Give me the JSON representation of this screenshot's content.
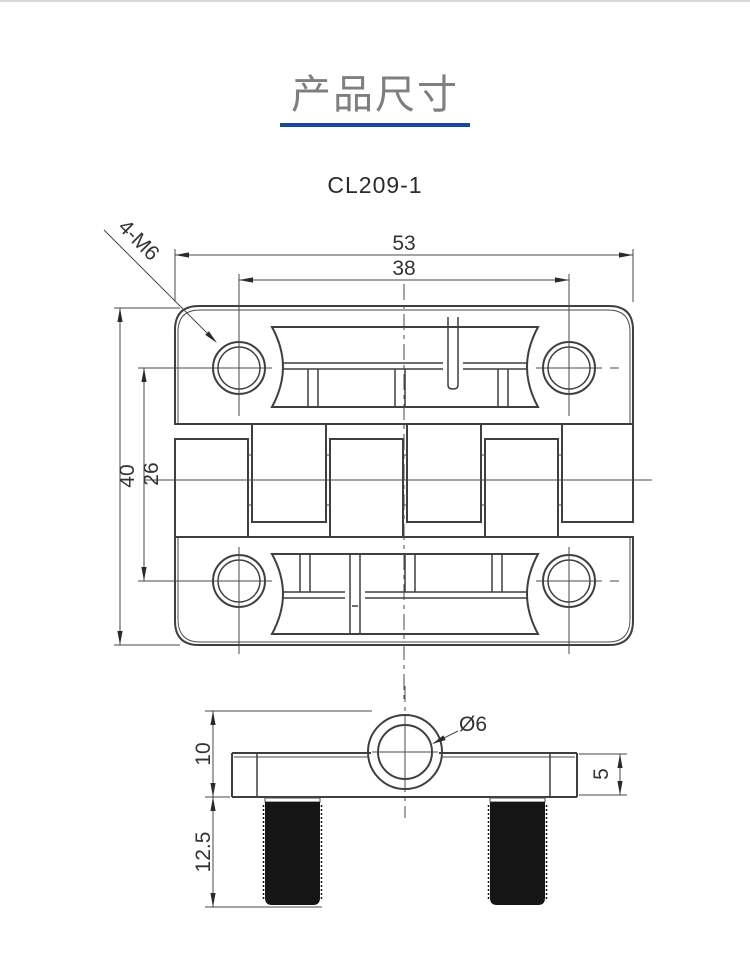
{
  "page": {
    "title": "产品尺寸",
    "model": "CL209-1",
    "accent_color": "#164a9c",
    "title_color": "#7f7f7f",
    "line_color": "#3f3f3f"
  },
  "drawing": {
    "type": "technical-drawing",
    "dims": {
      "overall_width": "53",
      "hole_pitch_h": "38",
      "overall_height": "40",
      "hole_pitch_v": "26",
      "thread_callout": "4-M6",
      "knuckle_height": "10",
      "stud_length": "12.5",
      "leaf_thickness": "5",
      "pin_hole_dia": "Ø6"
    }
  }
}
